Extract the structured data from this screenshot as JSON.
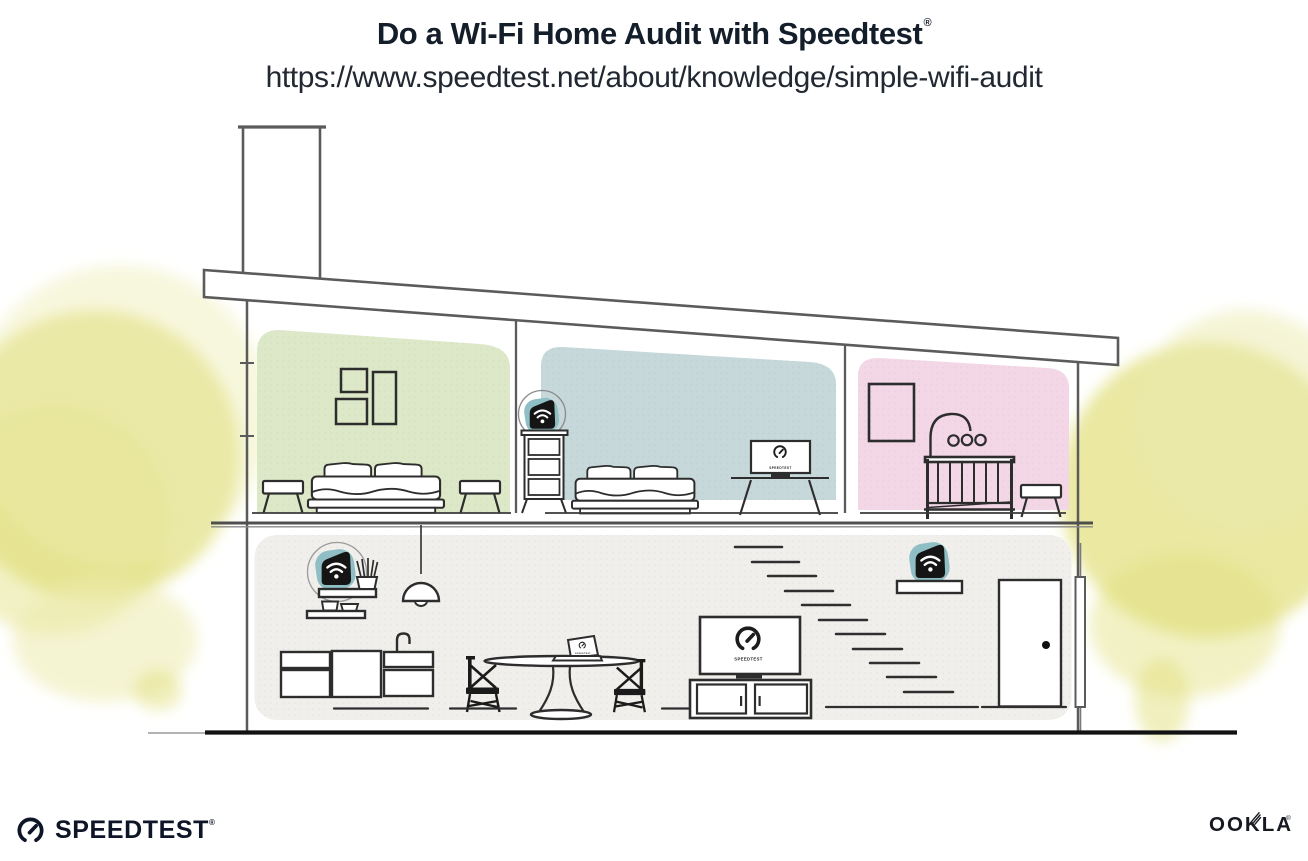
{
  "header": {
    "title": "Do a Wi-Fi Home Audit with Speedtest",
    "registered_mark": "®",
    "url": "https://www.speedtest.net/about/knowledge/simple-wifi-audit"
  },
  "illustration": {
    "screen_labels": {
      "bedroom_monitor": "SPEEDTEST",
      "living_tv": "SPEEDTEST",
      "dining_laptop": "SPEEDTEST"
    },
    "wifi_devices": [
      {
        "name": "wifi-extender-on-bedroom-dresser"
      },
      {
        "name": "wifi-router-on-kitchen-shelf"
      },
      {
        "name": "wifi-extender-on-living-room-shelf"
      }
    ],
    "colors": {
      "room_green": "#dde8c8",
      "room_blue": "#c6d8da",
      "room_pink": "#f3d7e6",
      "room_lower": "#f0efec",
      "tree": "#e2df7e",
      "tree_light": "#ecebad",
      "device_teal": "#8fbfc5",
      "ink": "#2d2d2d",
      "structure": "#5b5b5b",
      "brand_dark": "#10182a"
    }
  },
  "footer": {
    "speedtest_wordmark": "SPEEDTEST",
    "speedtest_registered": "®",
    "ookla_wordmark": "OOKLA",
    "ookla_registered": "®"
  }
}
